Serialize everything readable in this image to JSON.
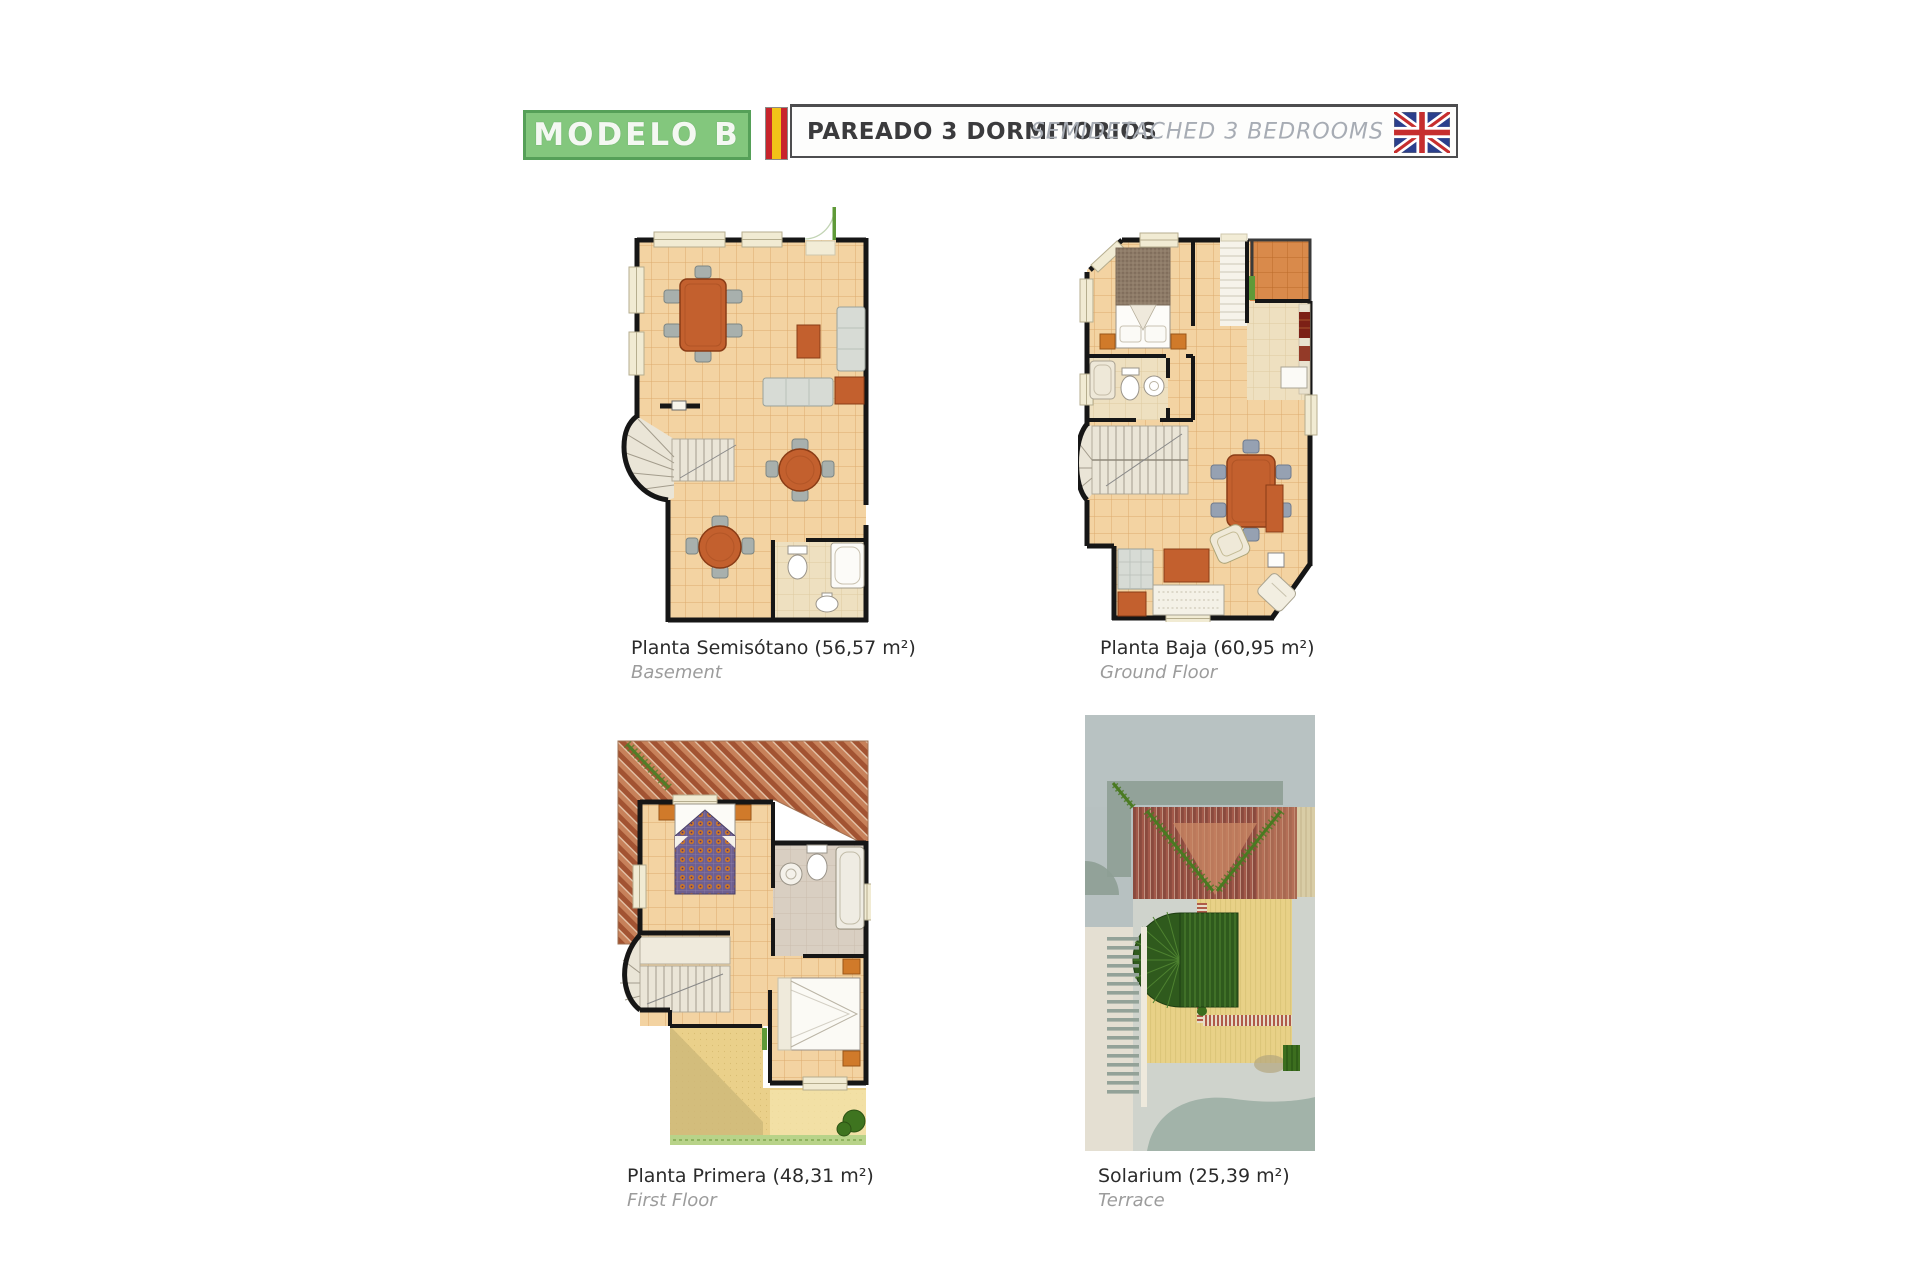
{
  "header": {
    "model_label": "MODELO B",
    "type_es": "PAREADO 3 DORMITORIOS",
    "type_en": "SEMIDETACHED 3 BEDROOMS",
    "flags": [
      {
        "name": "spain-flag-icon"
      },
      {
        "name": "uk-flag-icon"
      }
    ],
    "colors": {
      "model_box_fill": "#83c77d",
      "model_box_border": "#55a058",
      "model_text": "#ffffff",
      "type_es_color": "#3b3b3d",
      "type_en_color": "#a7acb4",
      "bar_border": "#4d4d4f"
    }
  },
  "plans": [
    {
      "id": "basement",
      "title": "Planta Semisótano (56,57 m²)",
      "subtitle": "Basement"
    },
    {
      "id": "ground-floor",
      "title": "Planta Baja (60,95 m²)",
      "subtitle": "Ground Floor"
    },
    {
      "id": "first-floor",
      "title": "Planta Primera (48,31 m²)",
      "subtitle": "First Floor"
    },
    {
      "id": "solarium",
      "title": "Solarium (25,39 m²)",
      "subtitle": "Terrace"
    }
  ],
  "palette": {
    "wall": "#161616",
    "floor_tile": "#f3d3a2",
    "floor_tile_line": "#d49a58",
    "pale_tile": "#eee0c0",
    "terrace_tile": "#d98a4b",
    "furniture_orange": "#c3602e",
    "chair_gray": "#a8b0ad",
    "roof_red": "#9e4a28",
    "pergola_green": "#2f5a1d",
    "sand_yellow": "#e8d187",
    "hedge_green": "#b8d389",
    "window_cream": "#f1ebd3"
  }
}
